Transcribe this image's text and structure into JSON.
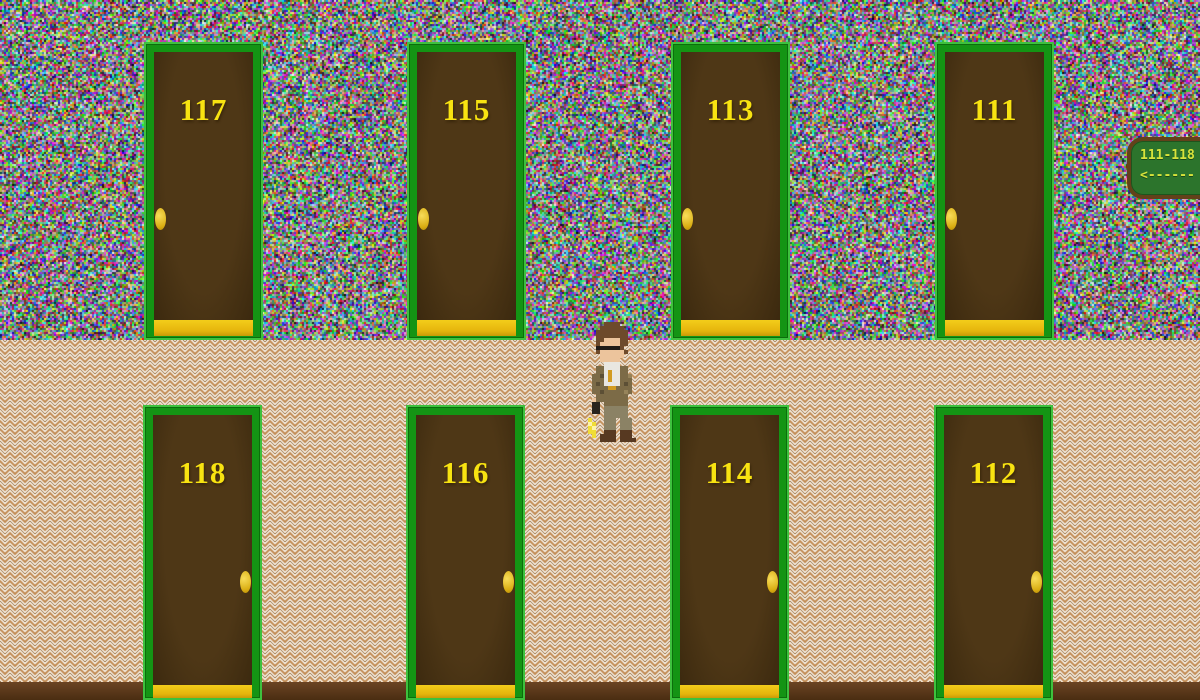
{
  "scene": {
    "name": "hotel-hallway",
    "wall_style": "static-noise-wallpaper",
    "floor_style": "tan-herringbone-zigzag"
  },
  "doors": {
    "top_row": [
      {
        "number": "117"
      },
      {
        "number": "115"
      },
      {
        "number": "113"
      },
      {
        "number": "111"
      }
    ],
    "bottom_row": [
      {
        "number": "118"
      },
      {
        "number": "116"
      },
      {
        "number": "114"
      },
      {
        "number": "112"
      }
    ]
  },
  "sign": {
    "range": "111-118",
    "arrow": "<------"
  },
  "player": {
    "description": "detective sprite with sunglasses holding item with yellow spark"
  },
  "colors": {
    "door_frame_green": "#149414",
    "door_frame_highlight": "#3ec13e",
    "door_panel_brown": "#4e3716",
    "door_number_yellow": "#f8e311",
    "doorknob_gold": "#edc72f",
    "kickplate_gold": "#e7b70d",
    "sign_bg_green": "#2c742c",
    "sign_border_brown": "#63411a",
    "sign_text_yellow": "#d9e33b",
    "floor_bg": "#faf6ee",
    "floor_tan": "#c08a52",
    "floor_dark": "#8d5e2b",
    "baseboard_brown": "#5c3a1c"
  }
}
